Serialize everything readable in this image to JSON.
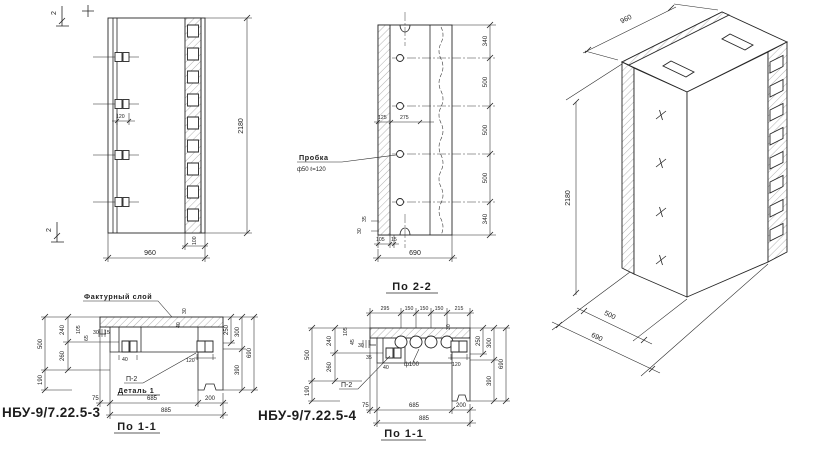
{
  "drawing": {
    "background": "#ffffff",
    "ink": "#262626",
    "front": {
      "marker_top": "2",
      "marker_bottom": "2",
      "dim_anchor": "120",
      "dim_height": "2180",
      "dim_width": "960",
      "dim_edge": "100"
    },
    "section22": {
      "title": "По 2-2",
      "plug_line1": "Пробка",
      "plug_line2": "ф50 ℓ=120",
      "right_dims": [
        "340",
        "500",
        "500",
        "500",
        "340"
      ],
      "top_dims": [
        "125",
        "275"
      ],
      "side_dims": [
        "35",
        "30"
      ],
      "bottom_dims": [
        "105",
        "15"
      ],
      "dim_width": "690"
    },
    "iso": {
      "dim_height": "2180",
      "dim_width": "960",
      "dim_500": "500",
      "dim_690": "690"
    },
    "plan3": {
      "mark": "НБУ-9/7.22.5-3",
      "view_label": "По 1-1",
      "facing_label": "Фактурный слой",
      "p2": "П-2",
      "detail": "Деталь 1",
      "left_dims": [
        "500",
        "240",
        "260",
        "190"
      ],
      "small_dims": [
        "105",
        "65",
        "30",
        "15",
        "40"
      ],
      "right_small": [
        "30",
        "40"
      ],
      "right_dims": [
        "250",
        "300",
        "390",
        "690"
      ],
      "dim_120": "120",
      "bottom_dims": [
        "75",
        "685",
        "200"
      ],
      "dim_total": "885"
    },
    "plan4": {
      "mark": "НБУ-9/7.22.5-4",
      "view_label": "По 1-1",
      "p2": "П-2",
      "hole": "ф100",
      "top_dims": [
        "295",
        "150",
        "150",
        "150",
        "215"
      ],
      "left_dims": [
        "500",
        "240",
        "260",
        "190"
      ],
      "small_dims": [
        "105",
        "45",
        "30",
        "35",
        "40"
      ],
      "right_small": [
        "30"
      ],
      "right_dims": [
        "250",
        "300",
        "390",
        "690"
      ],
      "dim_120": "120",
      "bottom_dims": [
        "75",
        "685",
        "200"
      ],
      "dim_total": "885"
    }
  }
}
